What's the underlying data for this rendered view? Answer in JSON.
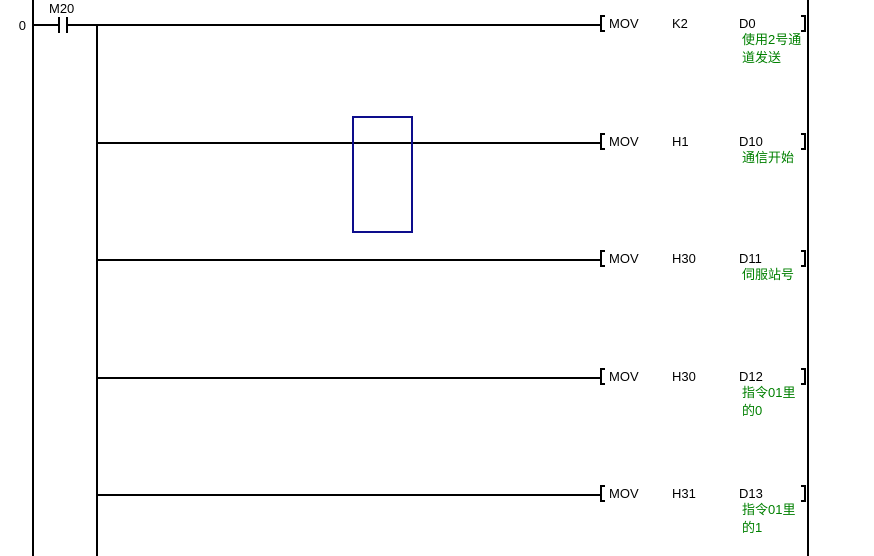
{
  "diagram": {
    "step_number": "0",
    "contact": {
      "label": "M20",
      "type": "normally-open-contact"
    },
    "rungs": [
      {
        "instruction": "MOV",
        "source": "K2",
        "dest": "D0",
        "comment": "使用2号通\n道发送"
      },
      {
        "instruction": "MOV",
        "source": "H1",
        "dest": "D10",
        "comment": "通信开始"
      },
      {
        "instruction": "MOV",
        "source": "H30",
        "dest": "D11",
        "comment": "伺服站号"
      },
      {
        "instruction": "MOV",
        "source": "H30",
        "dest": "D12",
        "comment": "指令01里\n的0"
      },
      {
        "instruction": "MOV",
        "source": "H31",
        "dest": "D13",
        "comment": "指令01里\n的1"
      }
    ],
    "cursor": {
      "col_x": 352,
      "row_y": 116,
      "width": 61,
      "height": 117
    },
    "colors": {
      "line": "#000000",
      "comment": "#008000",
      "cursor": "#0d0d8c",
      "background": "#ffffff"
    }
  }
}
